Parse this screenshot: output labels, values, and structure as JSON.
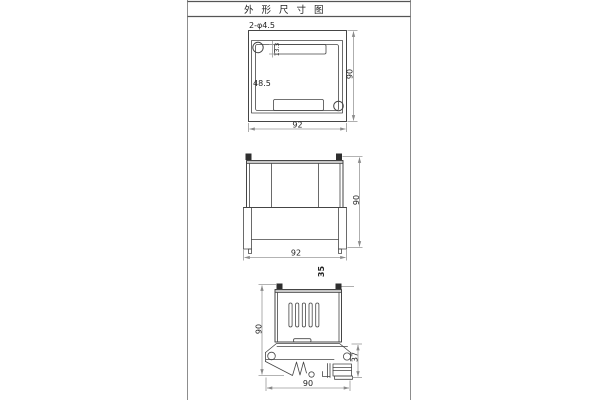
{
  "title": "外 形 尺 寸 图",
  "callouts": {
    "holes": "2-φ4.5"
  },
  "top_view": {
    "width": "92",
    "height": "90",
    "hole_offset": "48.5",
    "slot_height": "13.3"
  },
  "front_view": {
    "width": "92",
    "height": "90",
    "rail_width": "35"
  },
  "side_view": {
    "height": "90",
    "clip_depth": "37",
    "width": "90"
  },
  "colors": {
    "background": "#ffffff",
    "object_line": "#454545",
    "dimension_line": "#9a9a9a",
    "frame_line": "#8d8d8d",
    "dark_fill": "#2e2e2e",
    "band_fill": "#c6c6c6",
    "text": "#222222"
  }
}
